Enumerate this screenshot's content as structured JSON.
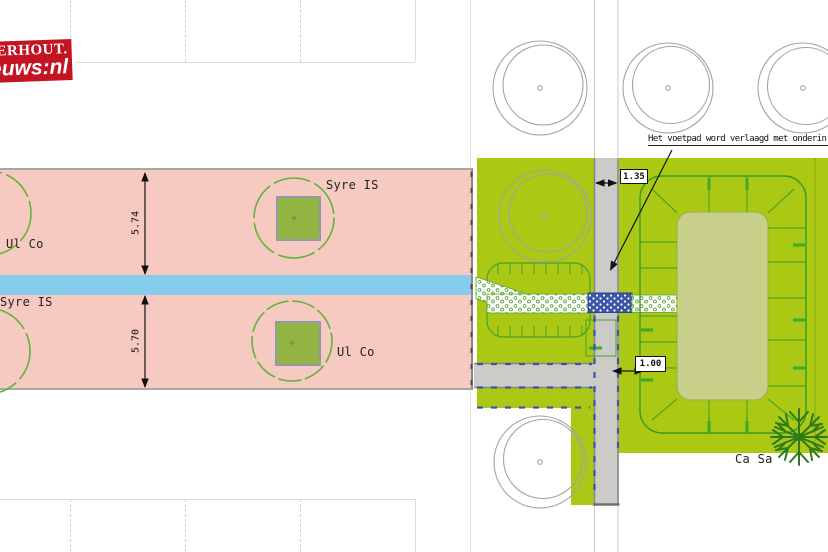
{
  "logo": {
    "line1": "TERHOUT.",
    "line2": "euws:nl"
  },
  "annotation": {
    "text": "Het voetpad word verlaagd met onderin ee"
  },
  "dimensions": {
    "left_upper": "5.74",
    "left_lower": "5.70",
    "path_width": "1.35",
    "verge_width": "1.00"
  },
  "tree_labels": {
    "syre_top": "Syre IS",
    "ul_left": "Ul Co",
    "syre_left": "Syre IS",
    "ul_mid": "Ul Co",
    "ca_sa": "Ca Sa"
  },
  "colors": {
    "pink_area": "#f6c9c1",
    "water_strip": "#86ccec",
    "grass": "#abc814",
    "block_olive": "#c7cf8a",
    "path_gray": "#cccbc7",
    "paving_blue": "#3a55a5",
    "logo_red": "#c31424",
    "tree_green": "#5fb43a",
    "dark_tree": "#2c7a1b"
  }
}
